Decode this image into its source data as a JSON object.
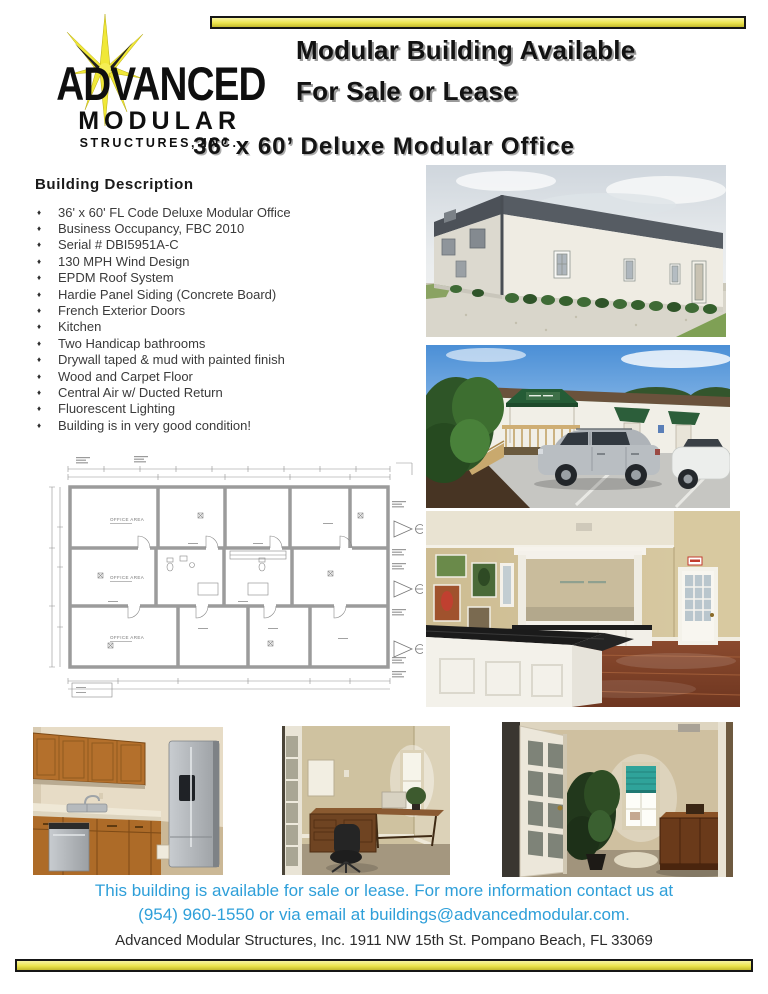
{
  "logo": {
    "line1": "ADVANCED",
    "line2": "MODULAR",
    "line3": "STRUCTURES, INC."
  },
  "header": {
    "title_line1": "Modular Building Available",
    "title_line2": "For Sale or Lease",
    "subtitle": "36’ x 60’ Deluxe Modular Office"
  },
  "description": {
    "heading": "Building Description",
    "bullet": "♦",
    "items": [
      "36' x 60' FL Code Deluxe Modular Office",
      "Business Occupancy, FBC 2010",
      "Serial # DBI5951A-C",
      "130 MPH Wind Design",
      "EPDM Roof System",
      "Hardie Panel Siding (Concrete Board)",
      "French Exterior Doors",
      "Kitchen",
      "Two Handicap bathrooms",
      "Drywall taped & mud with painted finish",
      "Wood and Carpet Floor",
      "Central Air w/ Ducted Return",
      "Fluorescent Lighting",
      "Building is in very good condition!"
    ]
  },
  "floor_plan": {
    "room_labels": [
      "OFFICE AREA",
      "OFFICE AREA",
      "OFFICE AREA"
    ]
  },
  "photos": {
    "exterior_front": "Exterior of white modular office building with dark metal roof and shrubs",
    "exterior_entrance": "Building entrance with green awnings, wood deck and parked cars",
    "interior_reception": "Reception area with white counter, mirror and dark wood floor",
    "kitchen": "Kitchen with oak cabinets and stainless appliances",
    "office_room_1": "Office room with wooden desks and chair",
    "office_room_2": "Office room with open french door, plant and shaded window"
  },
  "contact": {
    "line1": "This building is available for sale or lease. For more information contact us at",
    "line2": "(954) 960-1550 or via email at buildings@advancedmodular.com.",
    "address": "Advanced Modular Structures, Inc. 1911 NW 15th St. Pompano Beach, FL 33069"
  },
  "colors": {
    "accent_yellow": "#ece44e",
    "link_blue": "#2e9fd9"
  }
}
